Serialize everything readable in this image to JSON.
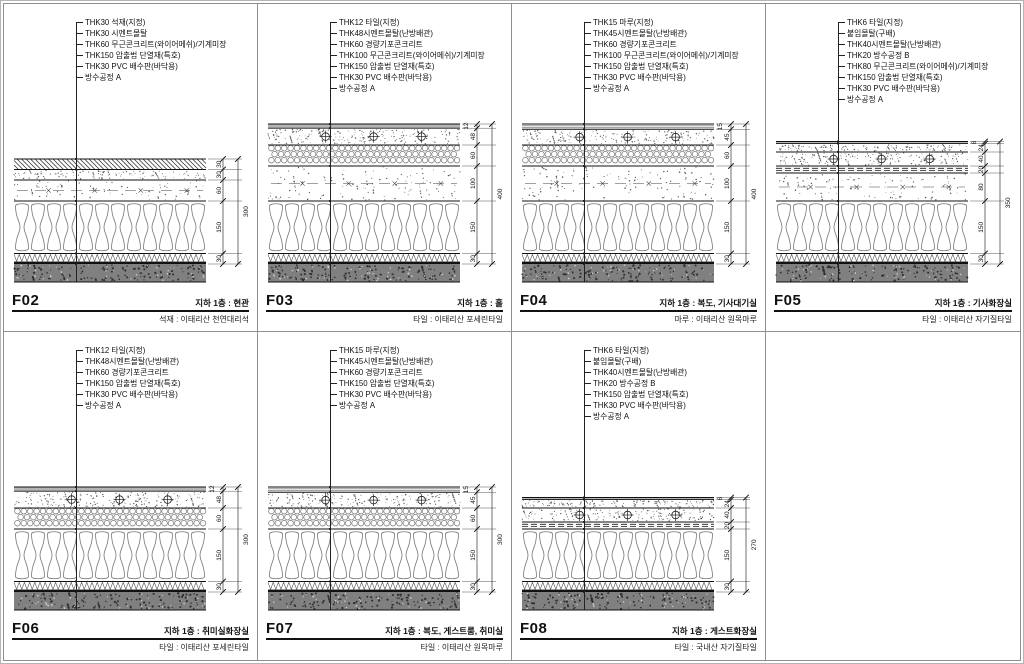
{
  "sheet": {
    "title": "floor-finish-details"
  },
  "colors": {
    "line": "#1a1a1a",
    "pattern": "#777777",
    "slab_fill": "#808080",
    "dim": "#444444"
  },
  "panels": [
    {
      "id": "F02",
      "location": "지하 1층 : 현관",
      "finish": "석재 : 이태리산 천연대리석",
      "callouts": [
        "THK30 석재(지정)",
        "THK30 시멘트몰탈",
        "THK60 무근콘크리트(와이어메쉬)/기계미장",
        "THK150 압출법 단열재(특호)",
        "THK30 PVC 배수판(바닥용)",
        "방수공정 A"
      ],
      "layers": [
        {
          "type": "stone",
          "mm": 30,
          "dim": "30"
        },
        {
          "type": "mortar",
          "mm": 30,
          "dim": "30"
        },
        {
          "type": "concrete",
          "mm": 60,
          "dim": "60"
        },
        {
          "type": "insulation",
          "mm": 150,
          "dim": "150"
        },
        {
          "type": "drain",
          "mm": 30,
          "dim": "30"
        }
      ],
      "total": "300"
    },
    {
      "id": "F03",
      "location": "지하 1층 : 홀",
      "finish": "타일 : 이태리산 포세린타일",
      "callouts": [
        "THK12 타일(지정)",
        "THK48시멘트몰탈(난방배관)",
        "THK60 경량기포콘크리트",
        "THK100 무근콘크리트(와이어메쉬)/기계미장",
        "THK150 압출법 단열재(특호)",
        "THK30 PVC 배수판(바닥용)",
        "방수공정 A"
      ],
      "layers": [
        {
          "type": "tile",
          "mm": 12,
          "dim": "12"
        },
        {
          "type": "mortar_pipe",
          "mm": 48,
          "dim": "48"
        },
        {
          "type": "foam",
          "mm": 60,
          "dim": "60"
        },
        {
          "type": "concrete",
          "mm": 100,
          "dim": "100"
        },
        {
          "type": "insulation",
          "mm": 150,
          "dim": "150"
        },
        {
          "type": "drain",
          "mm": 30,
          "dim": "30"
        }
      ],
      "total": "400"
    },
    {
      "id": "F04",
      "location": "지하 1층 : 복도, 기사대기실",
      "finish": "마루 : 이태리산 원목마루",
      "callouts": [
        "THK15 마루(지정)",
        "THK45시멘트몰탈(난방배관)",
        "THK60 경량기포콘크리트",
        "THK100 무근콘크리트(와이어메쉬)/기계미장",
        "THK150 압출법 단열재(특호)",
        "THK30 PVC 배수판(바닥용)",
        "방수공정 A"
      ],
      "layers": [
        {
          "type": "wood",
          "mm": 15,
          "dim": "15"
        },
        {
          "type": "mortar_pipe",
          "mm": 45,
          "dim": "45"
        },
        {
          "type": "foam",
          "mm": 60,
          "dim": "60"
        },
        {
          "type": "concrete",
          "mm": 100,
          "dim": "100"
        },
        {
          "type": "insulation",
          "mm": 150,
          "dim": "150"
        },
        {
          "type": "drain",
          "mm": 30,
          "dim": "30"
        }
      ],
      "total": "400"
    },
    {
      "id": "F05",
      "location": "지하 1층 : 기사화장실",
      "finish": "타일 : 이태리산 자기질타일",
      "callouts": [
        "THK6 타일(지정)",
        "붙임몰탈(구배)",
        "THK40시멘트몰탈(난방배관)",
        "THK20 방수공정 B",
        "THK80 무근콘크리트(와이어메쉬)/기계미장",
        "THK150 압출법 단열재(특호)",
        "THK30 PVC 배수판(바닥용)",
        "방수공정 A"
      ],
      "layers": [
        {
          "type": "tile",
          "mm": 6,
          "dim": "6"
        },
        {
          "type": "bond",
          "mm": 24,
          "dim": "24"
        },
        {
          "type": "mortar_pipe",
          "mm": 40,
          "dim": "40"
        },
        {
          "type": "waterproof",
          "mm": 20,
          "dim": "20"
        },
        {
          "type": "concrete",
          "mm": 80,
          "dim": "80"
        },
        {
          "type": "insulation",
          "mm": 150,
          "dim": "150"
        },
        {
          "type": "drain",
          "mm": 30,
          "dim": "30"
        }
      ],
      "total": "350"
    },
    {
      "id": "F06",
      "location": "지하 1층 : 취미실화장실",
      "finish": "타일 : 이태리산 포세린타일",
      "callouts": [
        "THK12 타일(지정)",
        "THK48시멘트몰탈(난방배관)",
        "THK60 경량기포콘크리트",
        "THK150 압출법 단열재(특호)",
        "THK30 PVC 배수판(바닥용)",
        "방수공정 A"
      ],
      "layers": [
        {
          "type": "tile",
          "mm": 12,
          "dim": "12"
        },
        {
          "type": "mortar_pipe",
          "mm": 48,
          "dim": "48"
        },
        {
          "type": "foam",
          "mm": 60,
          "dim": "60"
        },
        {
          "type": "insulation",
          "mm": 150,
          "dim": "150"
        },
        {
          "type": "drain",
          "mm": 30,
          "dim": "30"
        }
      ],
      "total": "300"
    },
    {
      "id": "F07",
      "location": "지하 1층 : 복도, 게스트룸, 취미실",
      "finish": "타일 : 이태리산 원목마루",
      "callouts": [
        "THK15 마루(지정)",
        "THK45시멘트몰탈(난방배관)",
        "THK60 경량기포콘크리트",
        "THK150 압출법 단열재(특호)",
        "THK30 PVC 배수판(바닥용)",
        "방수공정 A"
      ],
      "layers": [
        {
          "type": "wood",
          "mm": 15,
          "dim": "15"
        },
        {
          "type": "mortar_pipe",
          "mm": 45,
          "dim": "45"
        },
        {
          "type": "foam",
          "mm": 60,
          "dim": "60"
        },
        {
          "type": "insulation",
          "mm": 150,
          "dim": "150"
        },
        {
          "type": "drain",
          "mm": 30,
          "dim": "30"
        }
      ],
      "total": "300"
    },
    {
      "id": "F08",
      "location": "지하 1층 : 게스트화장실",
      "finish": "타일 : 국내산 자기질타일",
      "callouts": [
        "THK6 타일(지정)",
        "붙임몰탈(구배)",
        "THK40시멘트몰탈(난방배관)",
        "THK20 방수공정 B",
        "THK150 압출법 단열재(특호)",
        "THK30 PVC 배수판(바닥용)",
        "방수공정 A"
      ],
      "layers": [
        {
          "type": "tile",
          "mm": 6,
          "dim": "6"
        },
        {
          "type": "bond",
          "mm": 24,
          "dim": "24"
        },
        {
          "type": "mortar_pipe",
          "mm": 40,
          "dim": "40"
        },
        {
          "type": "waterproof",
          "mm": 20,
          "dim": "20"
        },
        {
          "type": "insulation",
          "mm": 150,
          "dim": "150"
        },
        {
          "type": "drain",
          "mm": 30,
          "dim": "30"
        }
      ],
      "total": "270"
    }
  ]
}
